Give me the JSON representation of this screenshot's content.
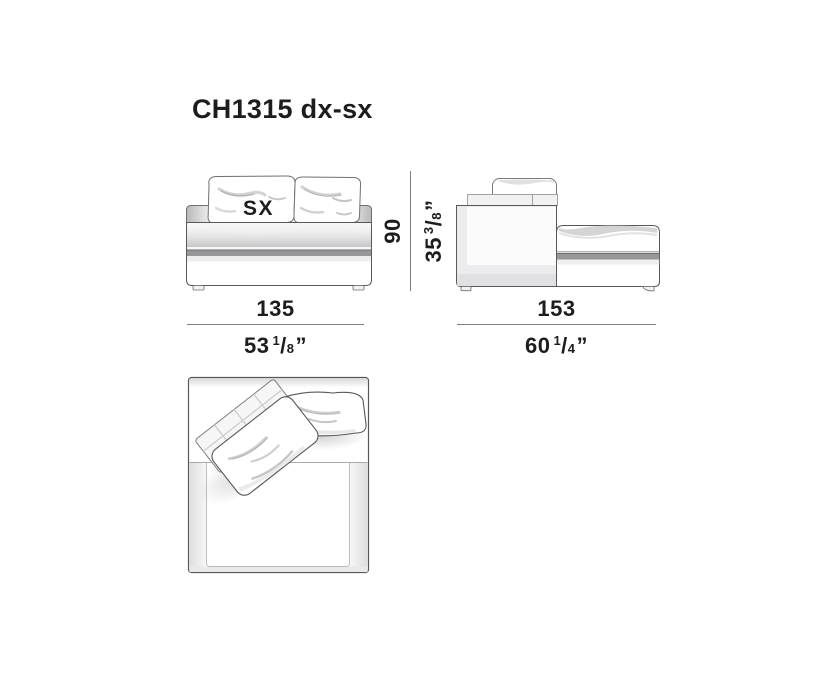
{
  "title": "CH1315 dx-sx",
  "front_view": {
    "cushion_label": "SX"
  },
  "dimensions": {
    "front_width": {
      "cm": "135",
      "inch_whole": "53",
      "frac_num": "1",
      "frac_den": "8",
      "inch_mark": "”"
    },
    "height": {
      "cm": "90",
      "inch_whole": "35",
      "frac_num": "3",
      "frac_den": "8",
      "inch_mark": "”"
    },
    "depth": {
      "cm": "153",
      "inch_whole": "60",
      "frac_num": "1",
      "frac_den": "4",
      "inch_mark": "”"
    }
  },
  "colors": {
    "ink": "#1d1d1b",
    "outline": "#58585a",
    "stripe": "#97979a",
    "dim_line": "#7c7c7e"
  }
}
